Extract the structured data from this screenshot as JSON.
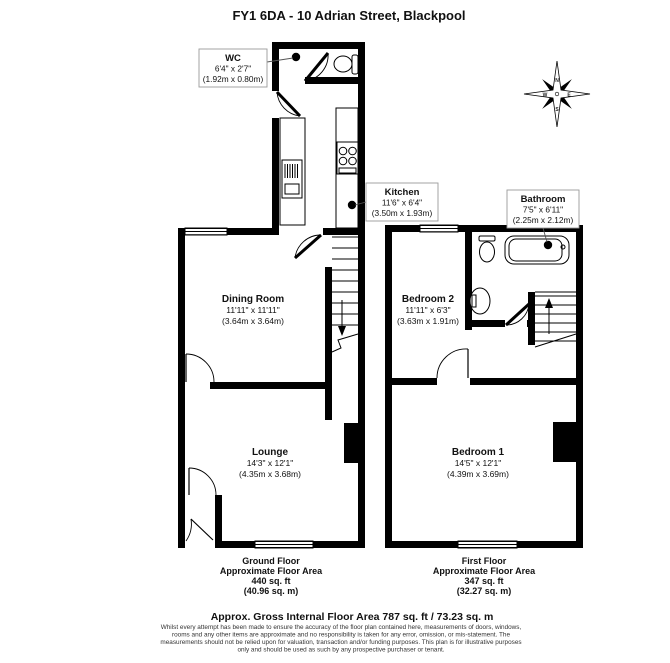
{
  "title": "FY1 6DA - 10 Adrian Street, Blackpool",
  "compass": {
    "north": "N",
    "east": "E",
    "south": "S",
    "west": "W"
  },
  "ground_floor": {
    "wc": {
      "name": "WC",
      "imperial": "6'4\" x 2'7\"",
      "metric": "(1.92m x 0.80m)"
    },
    "kitchen": {
      "name": "Kitchen",
      "imperial": "11'6\" x 6'4\"",
      "metric": "(3.50m x 1.93m)"
    },
    "dining_room": {
      "name": "Dining Room",
      "imperial": "11'11\" x 11'11\"",
      "metric": "(3.64m x 3.64m)"
    },
    "lounge": {
      "name": "Lounge",
      "imperial": "14'3\" x 12'1\"",
      "metric": "(4.35m x 3.68m)"
    },
    "caption": {
      "line1": "Ground Floor",
      "line2": "Approximate Floor Area",
      "line3": "440 sq. ft",
      "line4": "(40.96 sq. m)"
    }
  },
  "first_floor": {
    "bathroom": {
      "name": "Bathroom",
      "imperial": "7'5\" x 6'11\"",
      "metric": "(2.25m x 2.12m)"
    },
    "bedroom2": {
      "name": "Bedroom 2",
      "imperial": "11'11\" x 6'3\"",
      "metric": "(3.63m x 1.91m)"
    },
    "bedroom1": {
      "name": "Bedroom 1",
      "imperial": "14'5\" x 12'1\"",
      "metric": "(4.39m x 3.69m)"
    },
    "caption": {
      "line1": "First Floor",
      "line2": "Approximate Floor Area",
      "line3": "347 sq. ft",
      "line4": "(32.27 sq. m)"
    }
  },
  "footer": {
    "gross_area": "Approx. Gross Internal Floor Area 787 sq. ft / 73.23 sq. m",
    "disclaimer": [
      "Whilst every attempt has been made to ensure the accuracy of the floor plan contained here, measurements of doors, windows,",
      "rooms and any other items are approximate and no responsibility is taken for any error, omission, or mis-statement. The",
      "measurements should not be relied upon for valuation, transaction and/or funding purposes. This plan is for illustrative purposes",
      "only and should be used as such by any prospective purchaser or tenant."
    ]
  },
  "colors": {
    "wall": "#000000",
    "background": "#ffffff"
  }
}
